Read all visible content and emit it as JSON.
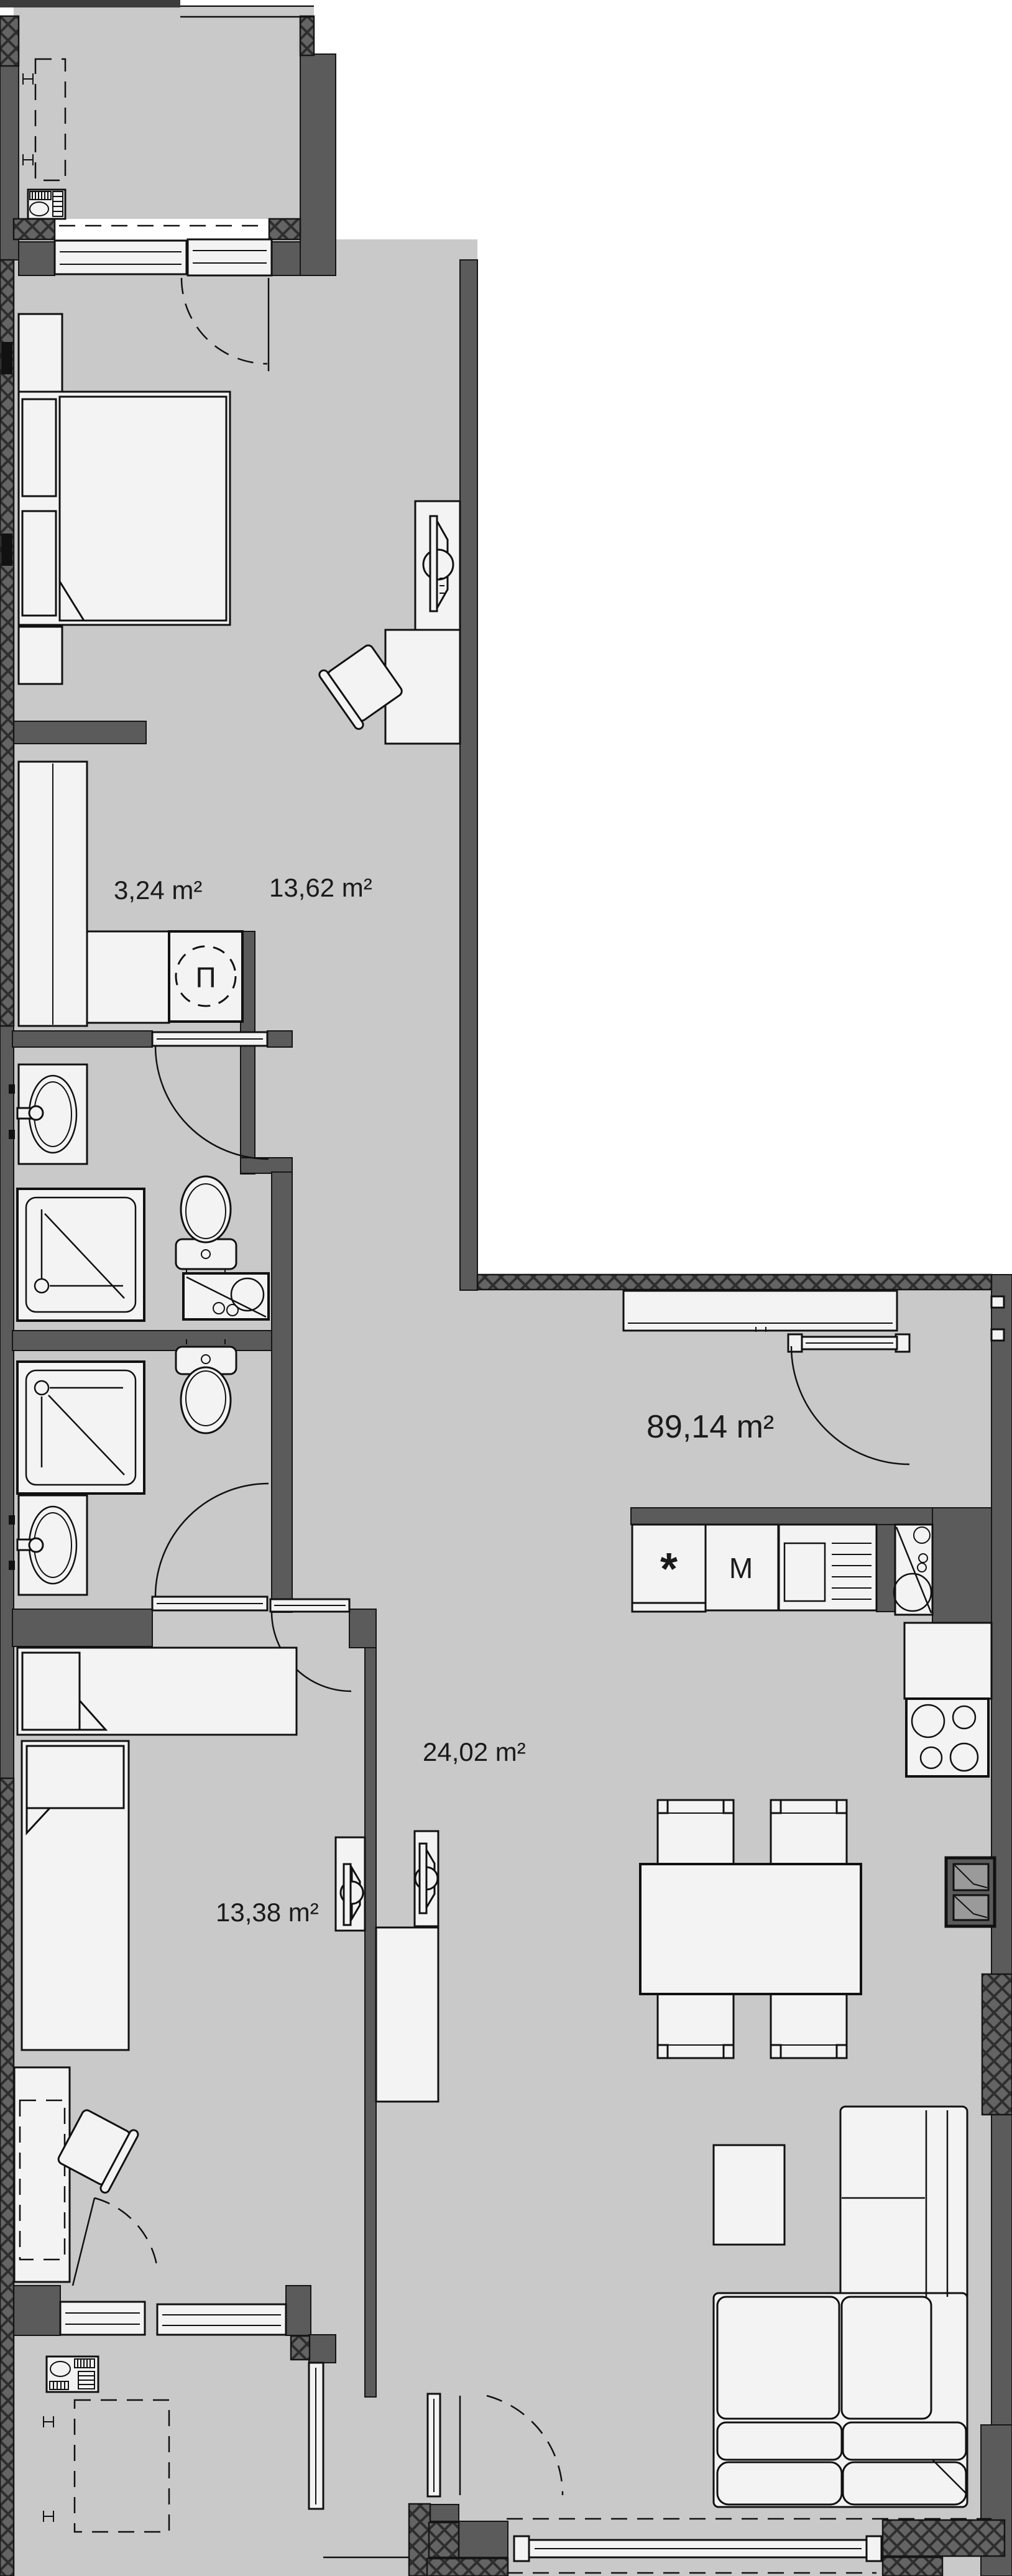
{
  "floorplan": {
    "total_area_label": "89,14 m²",
    "rooms": [
      {
        "id": "laundry",
        "area_label": "3,24 m²"
      },
      {
        "id": "bedroom-1",
        "area_label": "13,62 m²"
      },
      {
        "id": "bedroom-2",
        "area_label": "13,38 m²"
      },
      {
        "id": "living-kitchen",
        "area_label": "24,02 m²"
      }
    ],
    "symbols": {
      "washing_machine": "П",
      "fridge": "*",
      "oven": "M"
    },
    "colors": {
      "background": "#ffffff",
      "floor": "#c9c9c9",
      "wall": "#5b5b5b",
      "furniture": "#f3f3f3",
      "line": "#111111"
    }
  }
}
